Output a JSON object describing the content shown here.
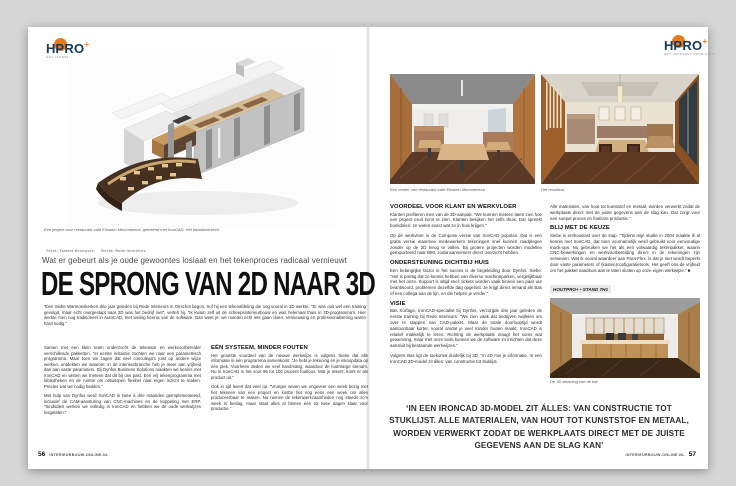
{
  "brand": {
    "name": "HOUTPRO+",
    "logo_h": "H",
    "logo_pro": "PRO",
    "logo_plus": "+",
    "logo_tagline": "HÉT VAKEVENT VOOR HOUT",
    "accent_orange": "#e87a1e",
    "navy": "#16395c"
  },
  "footer": {
    "site": "INTERIEURBOUW-ONLINE.NL",
    "left_page_number": "56",
    "right_page_number": "57"
  },
  "left_page": {
    "hero_caption": "Een project voor restaurant-café Einstein Mommeneck, getekend met IronCAD. Het totaaloverzicht.",
    "credit_text": "Tekst: Tamara Brouwers",
    "credit_image": "Beeld: Rede Interieurs",
    "kicker": "Wat er gebeurt als je oude gewoontes loslaat en het tekenproces radicaal vernieuwt",
    "headline": "DE SPRONG VAN 2D NAAR 3D",
    "lede": "Toen Siebe Warmoeskerken drie jaar geleden bij Rede Interieurs in Oirschot begon, trof hij een tekenafdeling die nog vooral in 2D werkte. “Er was ooit wel een training gevolgd, maar echt overgestapt naar 3D was het bedrijf niet”, vertelt hij. “Ik kwam zelf uit de scheepsinterieurbouw en was helemaal thuis in 3D-programma’s. Hier werkte men nog traditioneel in AutoCAD, met weinig kennis van de software. Dan weet je: we moeten echt iets gaan doen. Vernieuwing en professionalisering waren hard nodig.”",
    "col1_paras": [
      "Samen met een klein team onderzocht de tekenaar en werkvoorbereider verschillende pakketten. “In eerste instantie zochten we naar een parametrisch programma. Maar toen we zagen dat veel conculega’s juist op andere wijze werken, ontdekten we waarom: in de interieurbranche heb je meer aan vrijheid dan aan vaste parameters. Bij Dynfos Business Solutions maakten we kennis met IronCAD en wisten we meteen dat dit bij ons past. Een vrij tekenprogramma met bibliotheken en de ruimte om ontwerpen flexibel naar eigen inzicht te maken. Precies wat we nodig hadden.”",
      "Met hulp van Dynfos werd IronCAD in twee à drie maanden geïmplementeerd, inclusief de CAM-aansturing van CNC-machines en de koppeling met ERP. “Sindsdien werken we volledig in IronCAD en hebben we de oude werkwijzes losgelaten.”"
    ],
    "col2_heading": "EÉN SYSTEEM, MINDER FOUTEN",
    "col2_paras": [
      "Het grootste voordeel van de nieuwe werkwijze is volgens Siebe dat alle informatie in één programma samenkomt. “Je hebt je tekening én je inkoopdata op één plek. Voorheen deden we veel handmatig, waardoor de foutmarge toenam. Nu in IronCAD is het voor 95 tot 100 procent foutloos. Wat je tekent, komt er als product uit.”",
      "Ook in tijd levert dat veel op. “Vroeger waren we ongeveer een week bezig met het tekenen van een project en kostte het nog eens een week om alles produceerbaar te maken. Nu nemen de tekenwerkzaamheden nog steeds zo’n week in beslag, maar staat alles al binnen één tot twee dagen klaar voor productie.”"
    ]
  },
  "right_page": {
    "render_caption": "Een render van restaurant-café Einstein Mommeneck.",
    "photo_caption": "Het resultaat.",
    "col1": {
      "heading1": "VOORDEEL VOOR KLANT EN WERKVLOER",
      "para1": "Klanten profiteren mee van de 3D-aanpak. “We kunnen meteen laten zien hoe een project eruit komt te zien. Klanten bekijken het zelfs thuis. Dat spreekt boekdelen: ze weten exact wat ze in huis krijgen.”",
      "para2": "Op de werkvloer is de Compose versie van IronCAD populair. Dat is een gratis versie waarmee medewerkers tekeningen snel kunnen raadplegen zonder op de 2D terug te vallen. Bij grotere projecten worden modellen geëxporteerd naar BIM, zodat aannemers direct overzicht hebben.",
      "heading2": "ONDERSTEUNING DICHTBIJ HUIS",
      "para3": "Een belangrijke factor in het succes is de begeleiding door Dynfos. Siebe: “Het is prettig dat ze kennis hebben van diverse machineparken, vergelijkbaar met het onze. Support is altijd snel: tickets worden vaak binnen een paar uur beantwoord, problemen dezelfde dag opgelost. Je krijgt direct iemand als Bas of een collega aan de lijn, en die helpen je verder.”",
      "heading3": "VISIE",
      "para4": "Bas Korfage, IronCAD-specialist bij Dynfos, verzorgde drie jaar geleden de eerste training bij Rede Interieurs. “We zien vaak dat bedrijven twijfelen om over te stappen van CAD-pakket. Maar de totale doorlooptijd wordt aantoonbaar korter, vooral omdat je veel minder fouten maakt. IronCAD is relatief makkelijk te leren. Richting de werkplaats vraagt het soms wat gewenning, maar met onze tools kunnen we de software zo inrichten dat deze aansluit bij bestaande werkwijzen.”",
      "para5": "Volgens Bas ligt de toekomst duidelijk bij 3D. “In 2D mis je informatie. In een IronCAD 3D-model zit álles: van constructie tot stuklijst."
    },
    "col2": {
      "para1": "Alle materialen, van hout tot kunststof en metaal, worden verwerkt zodat de werkplaats direct met de juiste gegevens aan de slag kan. Dat zorgt voor een soepel proces en foutloze productie.”",
      "heading": "BLIJ MET DE KEUZE",
      "para2": "Siebe is enthousiast over de stap. “Tijdens mijn studie in 2004 maakte ik al kennis met IronCAD, dat toen voornamelijk werd gebruikt voor eenvoudige mock-ups. Nu gebruiken we het als een volwaardig tekenpakket, waarin CNC-bewerkingen en werkvoorbereiding direct in de tekeningen zijn verweven. Wat ik vooral waardeer aan Para-Flex, is dat je niet wordt beperkt door vaste parameters of (kasten)configuratietools. Het geeft ons de vrijheid om het pakket naadloos aan te laten sluiten op onze eigen werkwijze.” ■",
      "event_tag": "HOUTPRO+ • STAND 7H1",
      "bar_caption": "De 3D-tekening van de bar."
    },
    "pull_quote": "‘IN EEN IRONCAD 3D-MODEL ZIT ÁLLES: VAN CONSTRUCTIE TOT STUKLIJST. ALLE MATERIALEN, VAN HOUT TOT KUNSTSTOF EN METAAL, WORDEN VERWERKT ZODAT DE WERKPLAATS DIRECT MET DE JUISTE GEGEVENS AAN DE SLAG KAN’"
  }
}
